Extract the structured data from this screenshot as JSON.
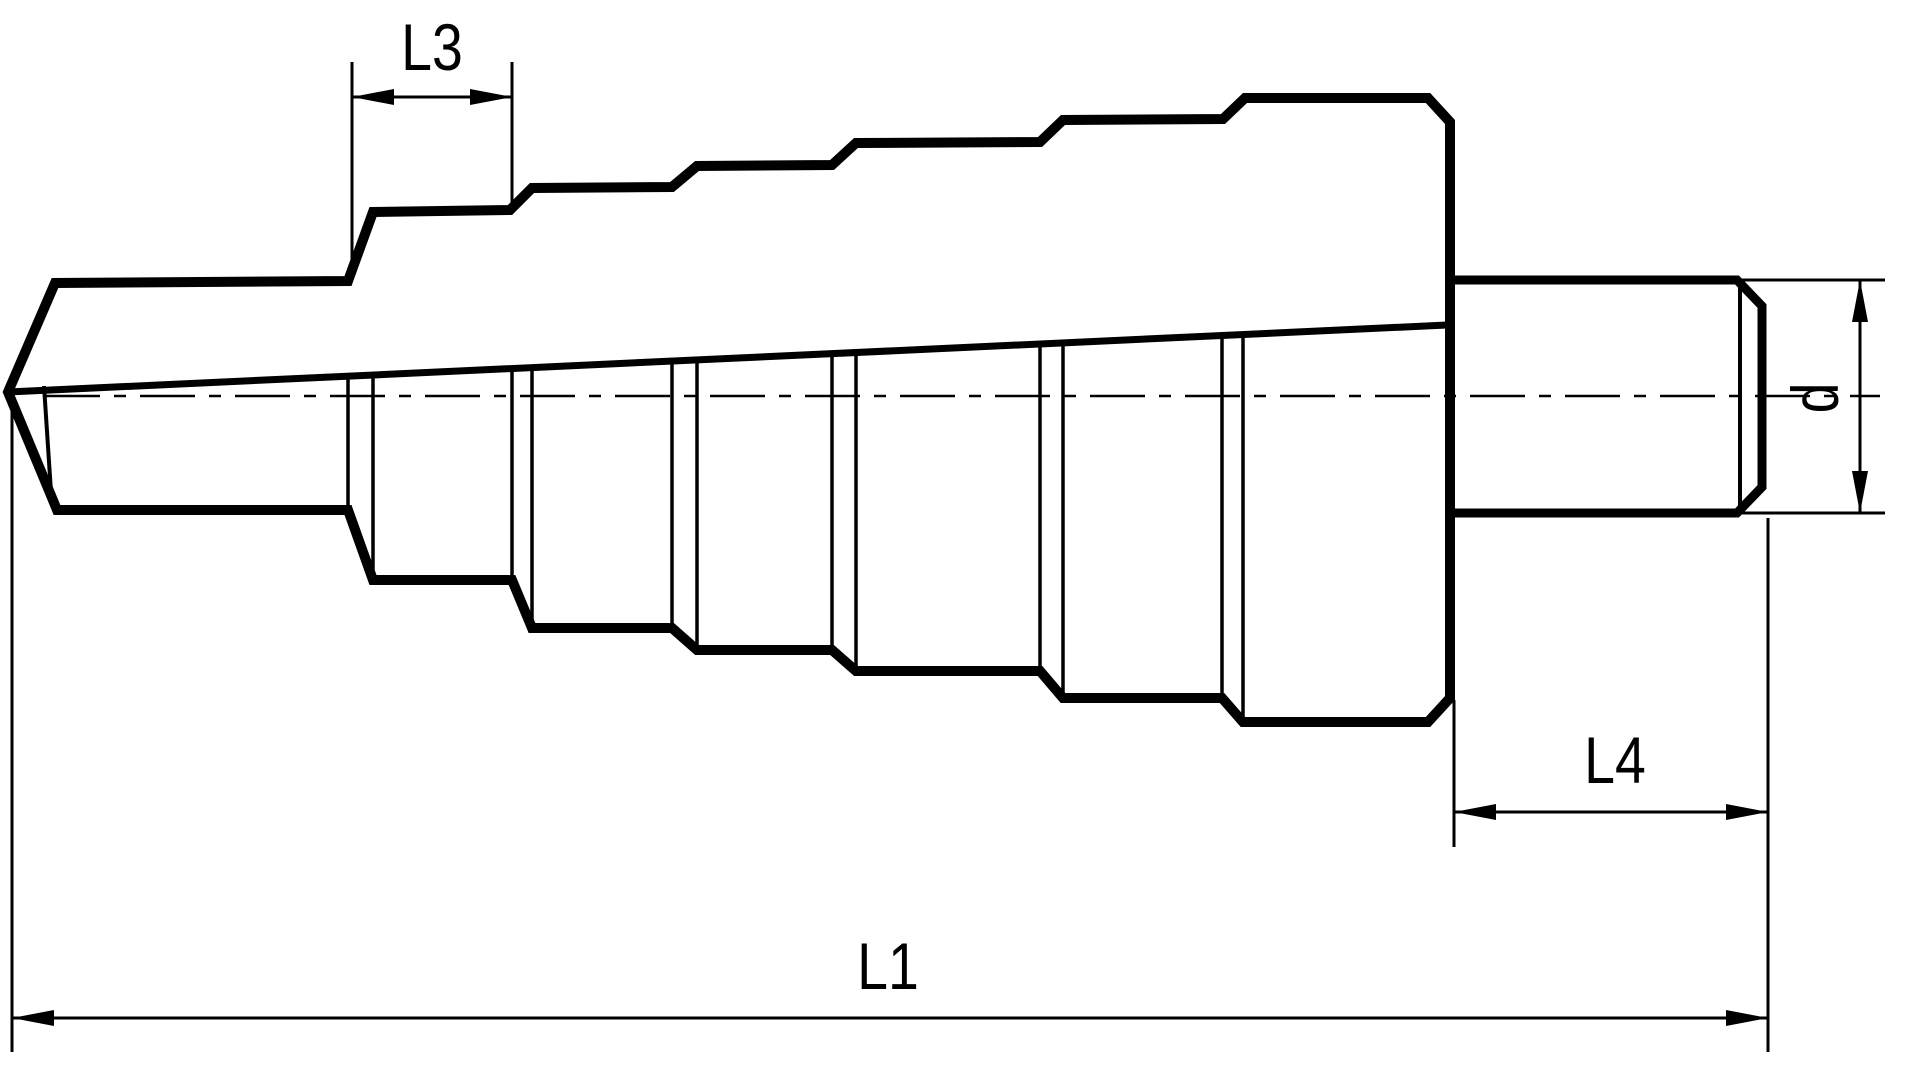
{
  "title": "Step drill bit dimensional drawing",
  "labels": {
    "l3": "L3",
    "l1": "L1",
    "l4": "L4",
    "d": "d"
  },
  "colors": {
    "line": "#000000",
    "background": "#ffffff"
  },
  "drawing": {
    "canvas": {
      "w": 1920,
      "h": 1091
    },
    "outline": [
      [
        8,
        392
      ],
      [
        55,
        283
      ],
      [
        348,
        281
      ],
      [
        373,
        212
      ],
      [
        510,
        210
      ],
      [
        532,
        188
      ],
      [
        672,
        187
      ],
      [
        697,
        166
      ],
      [
        832,
        165
      ],
      [
        856,
        143
      ],
      [
        1040,
        142
      ],
      [
        1063,
        120
      ],
      [
        1223,
        119
      ],
      [
        1245,
        98
      ],
      [
        1428,
        98
      ],
      [
        1450,
        122
      ],
      [
        1450,
        698
      ],
      [
        1428,
        722
      ],
      [
        1243,
        722
      ],
      [
        1222,
        698
      ],
      [
        1063,
        698
      ],
      [
        1040,
        671
      ],
      [
        856,
        671
      ],
      [
        832,
        650
      ],
      [
        697,
        650
      ],
      [
        672,
        628
      ],
      [
        532,
        628
      ],
      [
        512,
        580
      ],
      [
        373,
        580
      ],
      [
        348,
        510
      ],
      [
        57,
        510
      ],
      [
        50,
        493
      ]
    ],
    "shank": [
      [
        1452,
        280
      ],
      [
        1737,
        280
      ],
      [
        1762,
        306
      ],
      [
        1762,
        487
      ],
      [
        1737,
        513
      ],
      [
        1452,
        513
      ]
    ],
    "shank_chamfer_line": [
      [
        1740,
        282
      ],
      [
        1740,
        511
      ]
    ],
    "taper_line": [
      [
        8,
        392
      ],
      [
        1447,
        325
      ]
    ],
    "tip_inner_line": [
      [
        44,
        386
      ],
      [
        51,
        492
      ]
    ],
    "centerline": [
      [
        45,
        396
      ],
      [
        1880,
        396
      ]
    ],
    "step_face_lines": [
      [
        [
          348,
          376
        ],
        [
          348,
          510
        ]
      ],
      [
        [
          373,
          375
        ],
        [
          373,
          580
        ]
      ],
      [
        [
          512,
          368
        ],
        [
          512,
          580
        ]
      ],
      [
        [
          532,
          367
        ],
        [
          532,
          628
        ]
      ],
      [
        [
          672,
          361
        ],
        [
          672,
          628
        ]
      ],
      [
        [
          697,
          360
        ],
        [
          697,
          650
        ]
      ],
      [
        [
          832,
          353
        ],
        [
          832,
          650
        ]
      ],
      [
        [
          856,
          352
        ],
        [
          856,
          671
        ]
      ],
      [
        [
          1040,
          344
        ],
        [
          1040,
          671
        ]
      ],
      [
        [
          1063,
          343
        ],
        [
          1063,
          698
        ]
      ],
      [
        [
          1222,
          335
        ],
        [
          1222,
          698
        ]
      ],
      [
        [
          1243,
          334
        ],
        [
          1243,
          722
        ]
      ]
    ],
    "line_widths": {
      "outline": 10,
      "shank": 9,
      "taper": 7,
      "tip_inner": 4,
      "step_face": 3.5,
      "chamfer_line": 4,
      "centerline": 2.5,
      "dimension": 3
    },
    "arrow": {
      "length": 42,
      "half_width": 8
    },
    "dimensions": {
      "L3": {
        "ext": [
          [
            [
              352,
              62
            ],
            [
              352,
              270
            ]
          ],
          [
            [
              512,
              62
            ],
            [
              512,
              203
            ]
          ]
        ],
        "line": [
          [
            352,
            97
          ],
          [
            512,
            97
          ]
        ],
        "arrows": [
          {
            "tip": [
              352,
              97
            ],
            "dir": "left"
          },
          {
            "tip": [
              512,
              97
            ],
            "dir": "right"
          }
        ],
        "label_pos": [
          432,
          47
        ],
        "rotate": 0,
        "bind": "labels.l3"
      },
      "L4": {
        "ext": [
          [
            [
              1454,
              700
            ],
            [
              1454,
              847
            ]
          ],
          [
            [
              1768,
              518
            ],
            [
              1768,
              1052
            ]
          ]
        ],
        "line": [
          [
            1454,
            812
          ],
          [
            1768,
            812
          ]
        ],
        "arrows": [
          {
            "tip": [
              1454,
              812
            ],
            "dir": "left"
          },
          {
            "tip": [
              1768,
              812
            ],
            "dir": "right"
          }
        ],
        "label_pos": [
          1615,
          760
        ],
        "rotate": 0,
        "bind": "labels.l4"
      },
      "L1": {
        "ext": [
          [
            [
              12,
              400
            ],
            [
              12,
              1052
            ]
          ]
        ],
        "line": [
          [
            12,
            1018
          ],
          [
            1768,
            1018
          ]
        ],
        "arrows": [
          {
            "tip": [
              12,
              1018
            ],
            "dir": "left"
          },
          {
            "tip": [
              1768,
              1018
            ],
            "dir": "right"
          }
        ],
        "label_pos": [
          888,
          966
        ],
        "rotate": 0,
        "bind": "labels.l1"
      },
      "d": {
        "ext": [
          [
            [
              1742,
              280
            ],
            [
              1885,
              280
            ]
          ],
          [
            [
              1742,
              513
            ],
            [
              1885,
              513
            ]
          ]
        ],
        "line": [
          [
            1860,
            280
          ],
          [
            1860,
            513
          ]
        ],
        "arrows": [
          {
            "tip": [
              1860,
              280
            ],
            "dir": "up"
          },
          {
            "tip": [
              1860,
              513
            ],
            "dir": "down"
          }
        ],
        "label_pos": [
          1815,
          398
        ],
        "rotate": -90,
        "bind": "labels.d"
      }
    }
  }
}
